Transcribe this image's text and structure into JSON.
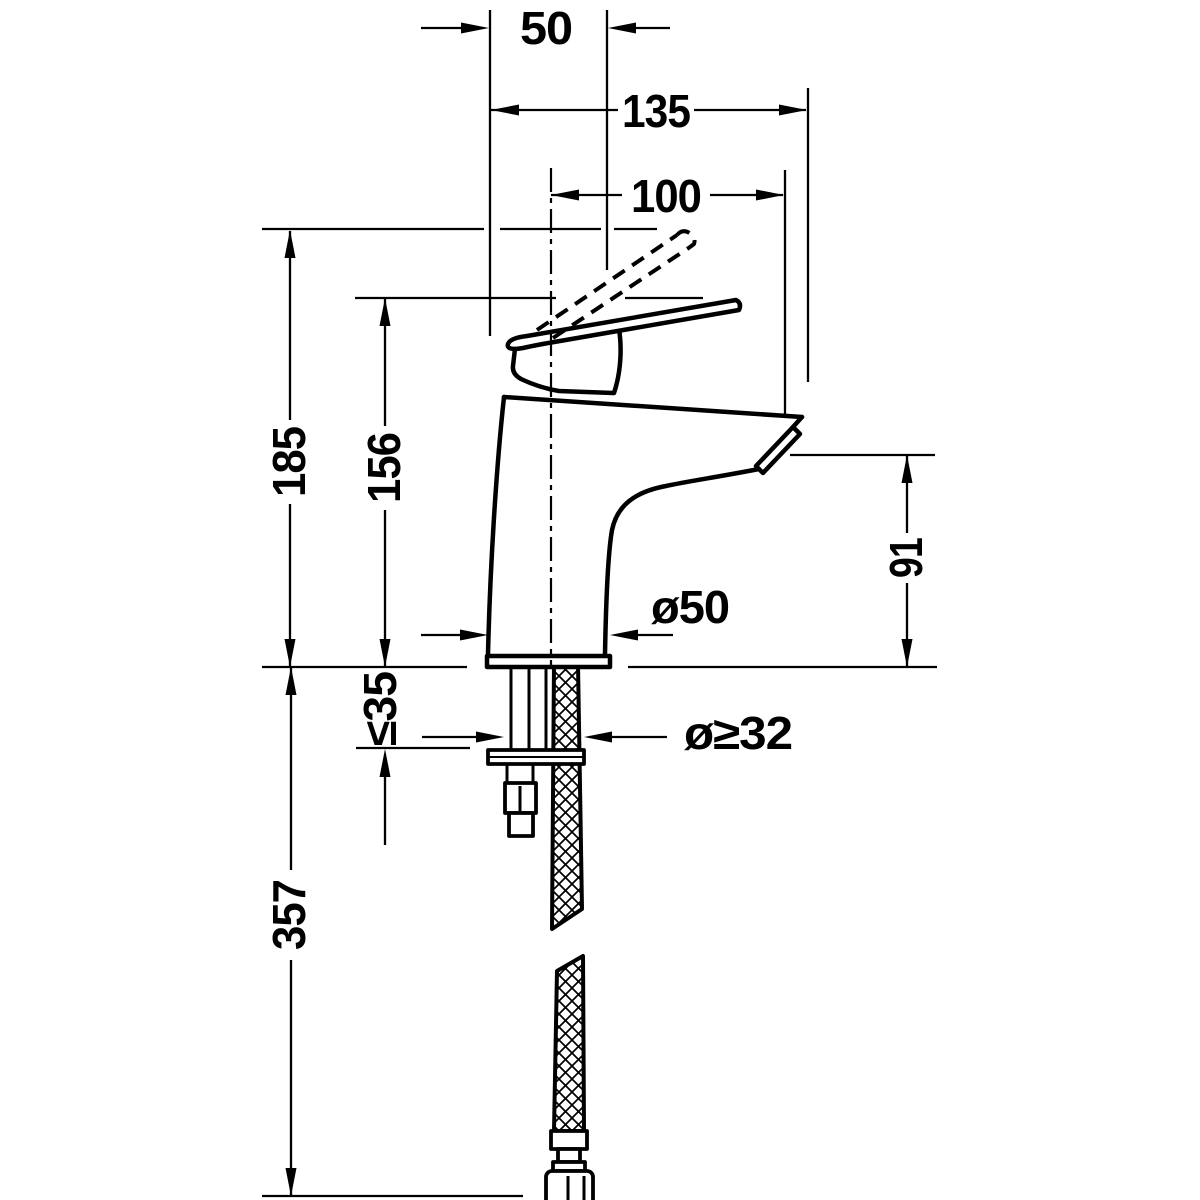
{
  "drawing": {
    "title": "single-lever-basin-mixer-dimension-drawing",
    "background_color": "#ffffff",
    "line_color": "#000000",
    "dimensions": {
      "width_50": "50",
      "projection_135": "135",
      "projection_100": "100",
      "height_185": "185",
      "height_156": "156",
      "spout_height_91": "91",
      "base_diameter": "ø50",
      "deck_thickness_max": "≤35",
      "hole_diameter_min": "ø≥32",
      "hose_length_357": "357"
    }
  }
}
